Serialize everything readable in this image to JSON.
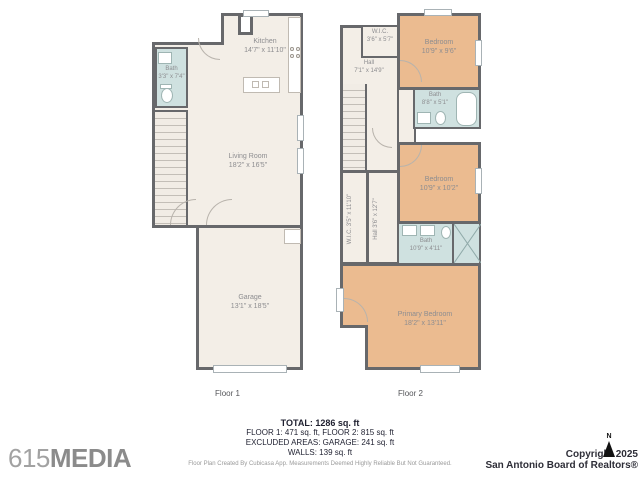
{
  "colors": {
    "wall": "#67686b",
    "room_floor": "#f3eee7",
    "bedroom_fill": "#ebbb90",
    "bath_fill": "#cfe1e0",
    "room_label": "#8d8d90"
  },
  "floor1": {
    "label": "Floor 1",
    "rooms": {
      "kitchen": {
        "name": "Kitchen",
        "dims": "14'7\" x 11'10\""
      },
      "bath": {
        "name": "Bath",
        "dims": "3'3\" x 7'4\""
      },
      "living_room": {
        "name": "Living Room",
        "dims": "18'2\" x 16'5\""
      },
      "garage": {
        "name": "Garage",
        "dims": "13'1\" x 18'5\""
      }
    }
  },
  "floor2": {
    "label": "Floor 2",
    "rooms": {
      "wic_top": {
        "name": "W.I.C.",
        "dims": "3'6\" x 5'7\""
      },
      "bedroom_top": {
        "name": "Bedroom",
        "dims": "10'9\" x 9'6\""
      },
      "bath_top": {
        "name": "Bath",
        "dims": "8'8\" x 5'1\""
      },
      "hall": {
        "name": "Hall",
        "dims": "7'1\" x 14'9\""
      },
      "bedroom_mid": {
        "name": "Bedroom",
        "dims": "10'9\" x 10'2\""
      },
      "wic_vertical": {
        "name": "W.I.C.",
        "dims": "3'5\" x 11'10\""
      },
      "hall_vertical": {
        "name": "Hall",
        "dims": "3'6\" x 12'7\""
      },
      "bath_mid": {
        "name": "Bath",
        "dims": "10'9\" x 4'11\""
      },
      "primary_bedroom": {
        "name": "Primary Bedroom",
        "dims": "18'2\" x 13'11\""
      }
    }
  },
  "summary": {
    "total": "TOTAL: 1286 sq. ft",
    "floors": "FLOOR 1: 471 sq. ft, FLOOR 2: 815 sq. ft",
    "excluded": "EXCLUDED AREAS: GARAGE: 241 sq. ft",
    "walls": "WALLS: 139 sq. ft",
    "disclaimer": "Floor Plan Created By Cubicasa App. Measurements Deemed Highly Reliable But Not Guaranteed."
  },
  "branding": {
    "logo_number": "615",
    "logo_word": "MEDIA",
    "compass_label": "N",
    "copyright_line1": "Copyright 2025",
    "copyright_line2": "San Antonio Board of Realtors®"
  }
}
